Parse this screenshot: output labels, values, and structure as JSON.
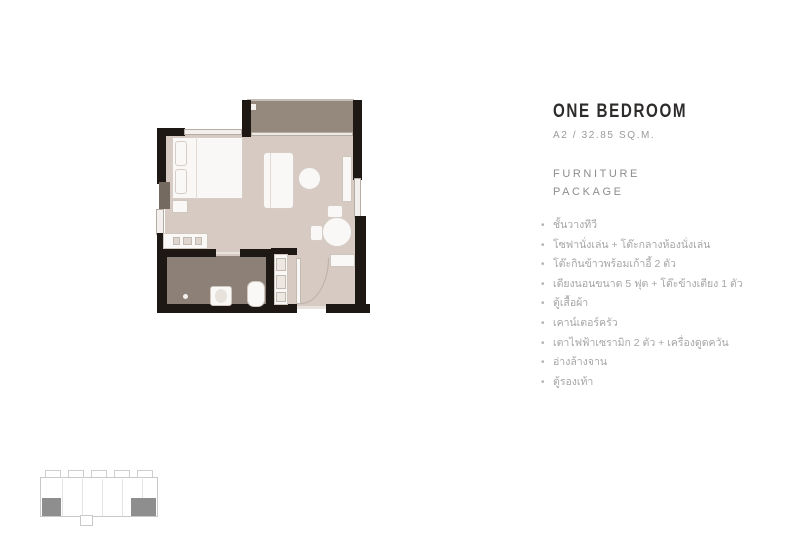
{
  "header": {
    "title": "ONE BEDROOM",
    "subtitle": "A2 / 32.85 SQ.M.",
    "section_line1": "FURNITURE",
    "section_line2": "PACKAGE"
  },
  "furniture_list": {
    "bullet": "•",
    "items": [
      "ชั้นวางทีวี",
      "โซฟานั่งเล่น + โต๊ะกลางห้องนั่งเล่น",
      "โต๊ะกินข้าวพร้อมเก้าอี้ 2 ตัว",
      "เตียงนอนขนาด 5 ฟุต + โต๊ะข้างเตียง 1 ตัว",
      "ตู้เสื้อผ้า",
      "เคาน์เตอร์ครัว",
      "เตาไฟฟ้าเซรามิก 2 ตัว + เครื่องดูดควัน",
      "อ่างล้างจาน",
      "ตู้รองเท้า"
    ]
  },
  "colors": {
    "wall": "#1d1813",
    "floor_main": "#d7cac2",
    "floor_balcony": "#95887d",
    "floor_bathroom": "#8d8076",
    "furniture": "#faf8f6",
    "furniture_border": "#cfc6be",
    "title_text": "#2e2c2b",
    "muted_text": "#9a9a9a",
    "keyplan_outline": "#c9c9c9",
    "keyplan_unit_highlight": "#8e8e8e"
  },
  "floorplan": {
    "elements": [
      {
        "name": "balcony-floor",
        "x": 247,
        "y": 101,
        "w": 107,
        "h": 33,
        "fill": "#95887d"
      },
      {
        "name": "main-floor",
        "x": 165,
        "y": 134,
        "w": 190,
        "h": 172,
        "fill": "#d7cac2"
      },
      {
        "name": "bathroom-floor",
        "x": 167,
        "y": 256,
        "w": 99,
        "h": 50,
        "fill": "#8d8076"
      },
      {
        "name": "balcony-rail-line",
        "x": 247,
        "y": 99,
        "w": 107,
        "h": 2,
        "fill": "#c6beb6"
      },
      {
        "name": "balcony-drain",
        "x": 250,
        "y": 104,
        "w": 6,
        "h": 6,
        "fill": "#f3f0ed"
      },
      {
        "name": "wall-top-left",
        "x": 157,
        "y": 128,
        "w": 28,
        "h": 8,
        "fill": "#1d1813"
      },
      {
        "name": "wall-left-upper",
        "x": 157,
        "y": 128,
        "w": 9,
        "h": 56,
        "fill": "#1d1813"
      },
      {
        "name": "duct-left",
        "x": 159,
        "y": 182,
        "w": 11,
        "h": 27,
        "fill": "#746a60"
      },
      {
        "name": "window-left",
        "x": 156,
        "y": 209,
        "w": 8,
        "h": 26,
        "fill": "#f2efec",
        "border": "#b5aca4"
      },
      {
        "name": "wall-left-lower",
        "x": 157,
        "y": 233,
        "w": 10,
        "h": 76,
        "fill": "#1d1813"
      },
      {
        "name": "wall-bottom-left",
        "x": 157,
        "y": 304,
        "w": 140,
        "h": 9,
        "fill": "#1d1813"
      },
      {
        "name": "entrance-threshold",
        "x": 297,
        "y": 306,
        "w": 29,
        "h": 3,
        "fill": "#e8e2dc"
      },
      {
        "name": "wall-bottom-right",
        "x": 326,
        "y": 304,
        "w": 44,
        "h": 9,
        "fill": "#1d1813"
      },
      {
        "name": "wall-right-upper",
        "x": 353,
        "y": 100,
        "w": 9,
        "h": 80,
        "fill": "#1d1813"
      },
      {
        "name": "window-right",
        "x": 354,
        "y": 178,
        "w": 7,
        "h": 40,
        "fill": "#f2efec",
        "border": "#b5aca4"
      },
      {
        "name": "wall-right-lower",
        "x": 355,
        "y": 216,
        "w": 11,
        "h": 92,
        "fill": "#1d1813"
      },
      {
        "name": "wall-balcony-left",
        "x": 242,
        "y": 100,
        "w": 9,
        "h": 37,
        "fill": "#1d1813"
      },
      {
        "name": "window-bedroom-top",
        "x": 184,
        "y": 129,
        "w": 58,
        "h": 6,
        "fill": "#f2efec",
        "border": "#b5aca4"
      },
      {
        "name": "balcony-sliding-door",
        "x": 251,
        "y": 132,
        "w": 102,
        "h": 4,
        "fill": "#efe9e4",
        "border": "#b5aca4"
      },
      {
        "name": "wall-bathroom-top-left",
        "x": 163,
        "y": 249,
        "w": 53,
        "h": 8,
        "fill": "#1d1813"
      },
      {
        "name": "bathroom-door-line",
        "x": 216,
        "y": 252,
        "w": 24,
        "h": 2,
        "fill": "#e8e2dc"
      },
      {
        "name": "wall-bathroom-top-right",
        "x": 240,
        "y": 249,
        "w": 35,
        "h": 8,
        "fill": "#1d1813"
      },
      {
        "name": "wall-bathroom-right",
        "x": 266,
        "y": 249,
        "w": 9,
        "h": 58,
        "fill": "#1d1813"
      },
      {
        "name": "wall-entry-top",
        "x": 271,
        "y": 248,
        "w": 26,
        "h": 7,
        "fill": "#1d1813"
      },
      {
        "name": "bed",
        "x": 172,
        "y": 137,
        "w": 71,
        "h": 62,
        "fill": "#faf8f6",
        "border": "#d5cdc6"
      },
      {
        "name": "bed-pillow-1",
        "x": 175,
        "y": 141,
        "w": 12,
        "h": 25,
        "fill": "#faf8f6",
        "border": "#d5cdc6",
        "radius": 3
      },
      {
        "name": "bed-pillow-2",
        "x": 175,
        "y": 169,
        "w": 12,
        "h": 25,
        "fill": "#faf8f6",
        "border": "#d5cdc6",
        "radius": 3
      },
      {
        "name": "bed-fold-line",
        "x": 196,
        "y": 137,
        "w": 1,
        "h": 62,
        "fill": "#e2dad3"
      },
      {
        "name": "nightstand",
        "x": 172,
        "y": 200,
        "w": 16,
        "h": 13,
        "fill": "#faf8f6",
        "border": "#cfc6be"
      },
      {
        "name": "sofa",
        "x": 263,
        "y": 152,
        "w": 31,
        "h": 57,
        "fill": "#faf8f6",
        "border": "#d5cdc6",
        "radius": 4
      },
      {
        "name": "sofa-back-line",
        "x": 270,
        "y": 153,
        "w": 1,
        "h": 55,
        "fill": "#e2dad3"
      },
      {
        "name": "coffee-table",
        "x": 298,
        "y": 167,
        "w": 23,
        "h": 23,
        "fill": "#faf8f6",
        "border": "#d5cdc6",
        "radius": "50%"
      },
      {
        "name": "tv-shelf",
        "x": 342,
        "y": 156,
        "w": 10,
        "h": 46,
        "fill": "#faf8f6",
        "border": "#cfc6be"
      },
      {
        "name": "dining-table",
        "x": 322,
        "y": 217,
        "w": 30,
        "h": 30,
        "fill": "#faf8f6",
        "border": "#d5cdc6",
        "radius": "50%"
      },
      {
        "name": "dining-chair-left",
        "x": 310,
        "y": 225,
        "w": 13,
        "h": 16,
        "fill": "#faf8f6",
        "border": "#d5cdc6",
        "radius": 3
      },
      {
        "name": "dining-chair-top",
        "x": 327,
        "y": 205,
        "w": 16,
        "h": 13,
        "fill": "#faf8f6",
        "border": "#d5cdc6",
        "radius": 3
      },
      {
        "name": "kitchen-counter",
        "x": 163,
        "y": 233,
        "w": 45,
        "h": 16,
        "fill": "#faf8f6",
        "border": "#cfc6be"
      },
      {
        "name": "sink-fixture-1",
        "x": 173,
        "y": 237,
        "w": 7,
        "h": 8,
        "fill": "#ddd5ce",
        "border": "#c2b9b1"
      },
      {
        "name": "sink-fixture-2",
        "x": 183,
        "y": 237,
        "w": 9,
        "h": 8,
        "fill": "#ddd5ce",
        "border": "#c2b9b1"
      },
      {
        "name": "sink-fixture-3",
        "x": 195,
        "y": 237,
        "w": 7,
        "h": 8,
        "fill": "#ddd5ce",
        "border": "#c2b9b1"
      },
      {
        "name": "kitchen-strip",
        "x": 274,
        "y": 254,
        "w": 14,
        "h": 51,
        "fill": "#faf8f6",
        "border": "#cfc6be"
      },
      {
        "name": "stove",
        "x": 276,
        "y": 258,
        "w": 10,
        "h": 13,
        "fill": "#eee8e3",
        "border": "#c2b9b1"
      },
      {
        "name": "fridge",
        "x": 276,
        "y": 275,
        "w": 10,
        "h": 14,
        "fill": "#eee8e3",
        "border": "#c2b9b1"
      },
      {
        "name": "appliance",
        "x": 276,
        "y": 292,
        "w": 10,
        "h": 10,
        "fill": "#eee8e3",
        "border": "#c2b9b1"
      },
      {
        "name": "shoe-cabinet",
        "x": 330,
        "y": 254,
        "w": 25,
        "h": 13,
        "fill": "#faf8f6",
        "border": "#cfc6be"
      },
      {
        "name": "entrance-door-leaf",
        "x": 296,
        "y": 258,
        "w": 5,
        "h": 46,
        "fill": "#faf8f6",
        "border": "#c2b9b1"
      },
      {
        "name": "entrance-door-arc",
        "x": 301,
        "y": 258,
        "w": 28,
        "h": 46,
        "shape": "arc"
      },
      {
        "name": "toilet",
        "x": 210,
        "y": 286,
        "w": 22,
        "h": 20,
        "fill": "#faf8f6",
        "border": "#cfc6be",
        "radius": 3
      },
      {
        "name": "toilet-seat",
        "x": 215,
        "y": 289,
        "w": 12,
        "h": 14,
        "fill": "#e8e2dc",
        "radius": "50%"
      },
      {
        "name": "bathtub",
        "x": 247,
        "y": 281,
        "w": 18,
        "h": 26,
        "fill": "#faf8f6",
        "border": "#cfc6be",
        "radius": 7
      },
      {
        "name": "bathroom-drain",
        "x": 183,
        "y": 294,
        "w": 5,
        "h": 5,
        "fill": "#f3f0ed",
        "radius": "50%"
      }
    ]
  },
  "keyplan": {
    "elements": [
      {
        "name": "keyplan-notch",
        "x": 45,
        "y": 470,
        "w": 16,
        "h": 8,
        "fill": "#ffffff",
        "border": "#cfcfcf"
      },
      {
        "name": "keyplan-notch",
        "x": 68,
        "y": 470,
        "w": 16,
        "h": 8,
        "fill": "#ffffff",
        "border": "#cfcfcf"
      },
      {
        "name": "keyplan-notch",
        "x": 91,
        "y": 470,
        "w": 16,
        "h": 8,
        "fill": "#ffffff",
        "border": "#cfcfcf"
      },
      {
        "name": "keyplan-notch",
        "x": 114,
        "y": 470,
        "w": 16,
        "h": 8,
        "fill": "#ffffff",
        "border": "#cfcfcf"
      },
      {
        "name": "keyplan-notch",
        "x": 137,
        "y": 470,
        "w": 16,
        "h": 8,
        "fill": "#ffffff",
        "border": "#cfcfcf"
      },
      {
        "name": "keyplan-body",
        "x": 40,
        "y": 477,
        "w": 118,
        "h": 40,
        "fill": "#ffffff",
        "border": "#c9c9c9"
      },
      {
        "name": "keyplan-divider",
        "x": 62,
        "y": 479,
        "w": 1,
        "h": 37,
        "fill": "#e3e3e3"
      },
      {
        "name": "keyplan-divider",
        "x": 82,
        "y": 479,
        "w": 1,
        "h": 37,
        "fill": "#e3e3e3"
      },
      {
        "name": "keyplan-divider",
        "x": 102,
        "y": 479,
        "w": 1,
        "h": 37,
        "fill": "#e3e3e3"
      },
      {
        "name": "keyplan-divider",
        "x": 122,
        "y": 479,
        "w": 1,
        "h": 37,
        "fill": "#e3e3e3"
      },
      {
        "name": "keyplan-divider",
        "x": 142,
        "y": 479,
        "w": 1,
        "h": 37,
        "fill": "#e3e3e3"
      },
      {
        "name": "keyplan-unit-highlight-left",
        "x": 42,
        "y": 498,
        "w": 19,
        "h": 18,
        "fill": "#8e8e8e"
      },
      {
        "name": "keyplan-unit-highlight-right",
        "x": 131,
        "y": 498,
        "w": 25,
        "h": 18,
        "fill": "#8e8e8e"
      },
      {
        "name": "keyplan-tab",
        "x": 80,
        "y": 515,
        "w": 13,
        "h": 11,
        "fill": "#ffffff",
        "border": "#c9c9c9"
      }
    ]
  }
}
